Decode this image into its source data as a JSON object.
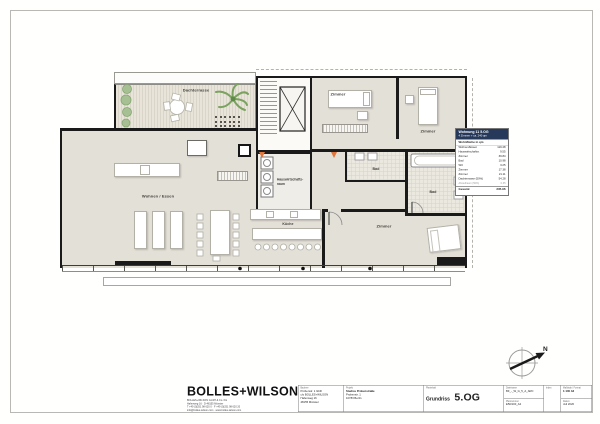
{
  "title_block": {
    "logo_text": "BOLLES+WILSON",
    "office_lines": [
      "BOLLES+WILSON GmbH & Co. KG",
      "Hafenweg 16 · D-48155 Münster",
      "T +49 (0)251 98 620 0 · F +49 (0)251 98 620 20",
      "info@bolles-wilson.com · www.bolles-wilson.com"
    ],
    "client_label": "Bauherr",
    "client_lines": [
      "Probenstr. 1 GbR",
      "c/o BOLLES+WILSON",
      "Hafenweg 16",
      "48155 Münster"
    ],
    "project_label": "Projekt",
    "project_name": "Studios Probenstraße",
    "project_addr1": "Probenstr. 1",
    "project_addr2": "10783 Berlin",
    "content_label": "Planinhalt",
    "content_type": "Grundriss",
    "content_floor": "5.OG",
    "file_label": "Dateiname",
    "file_value": "BF_-_W_G_5_A_ARC",
    "plannum_label": "Plannummer",
    "plannum_value": "E50/100_A2",
    "index_label": "Index",
    "scale_label": "Maßstab / Format",
    "scale_value": "1:100    A2",
    "date_label": "Datum",
    "date_value": "Juli 2020"
  },
  "apartment_info": {
    "title": "Wohnung 11  5.OG",
    "subtitle": "4 Zimmer + ca. 240 qm",
    "table_header": "Wohnfläche in  qm",
    "rows": [
      {
        "label": "Wohnen/Essen",
        "value": "119.48"
      },
      {
        "label": "Hauswirtschaftsr.",
        "value": "9.55"
      },
      {
        "label": "Zimmer",
        "value": "39.84"
      },
      {
        "label": "Bad",
        "value": "10.98"
      },
      {
        "label": "WC",
        "value": "3.25"
      },
      {
        "label": "Zimmer",
        "value": "17.38"
      },
      {
        "label": "Zimmer",
        "value": "21.11"
      },
      {
        "label": "Dachterrasse (50%)",
        "value": "54.28"
      },
      {
        "label": "Abstellraum (50%)",
        "value": "0.35"
      }
    ],
    "total_label": "Gesamt",
    "total_value": "235.96"
  },
  "rooms": {
    "terrace": "Dachterrasse",
    "living": "Wohnen / Essen",
    "utility1": "Hauswirtschafts-",
    "utility2": "raum",
    "bedroom1": "Zimmer",
    "bedroom2": "Zimmer",
    "bedroom3": "Zimmer",
    "bath1": "Bad",
    "bath2": "Bad",
    "kitchen": "Küche"
  },
  "compass": {
    "north": "N"
  },
  "colors": {
    "floor_fill": "#e3e0d7",
    "wall": "#1a1a1a",
    "info_header": "#27395a",
    "door_marker_orange": "#e0763c",
    "plant_green": "#a6c093"
  }
}
